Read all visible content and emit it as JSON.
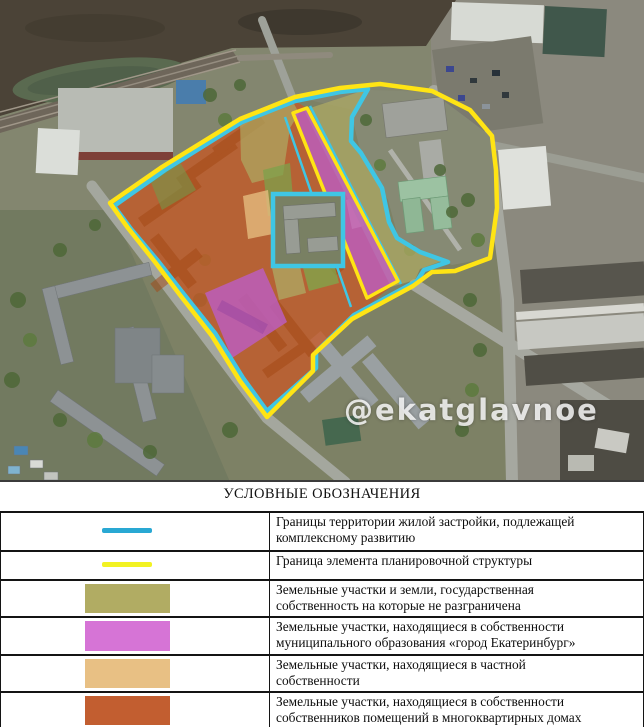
{
  "map": {
    "watermark": "@ekatglavnoe",
    "colors": {
      "boundary_cyan": "#3fc6e4",
      "boundary_yellow": "#ffe414",
      "state_unresolved": "#aeab64",
      "municipal": "#bd5ec6",
      "private": "#e5bc7e",
      "mkd": "#c65a28"
    }
  },
  "legend": {
    "title": "УСЛОВНЫЕ ОБОЗНАЧЕНИЯ",
    "rows": [
      {
        "swatch": "cyan-line",
        "color": "#29a8d3",
        "text": "Границы территории жилой застройки, подлежащей\nкомплексному развитию"
      },
      {
        "swatch": "yellow-line",
        "color": "#f2f222",
        "text": "Граница элемента планировочной структуры"
      },
      {
        "swatch": "olive-rect",
        "color": "#b1ac63",
        "text": "Земельные участки и земли, государственная\nсобственность на которые не разграничена"
      },
      {
        "swatch": "purple-rect",
        "color": "#d674d6",
        "text": "Земельные участки, находящиеся в собственности\nмуниципального образования «город Екатеринбург»"
      },
      {
        "swatch": "tan-rect",
        "color": "#e8c084",
        "text": "Земельные участки, находящиеся в частной\nсобственности"
      },
      {
        "swatch": "orange-rect",
        "color": "#c25e30",
        "text": "Земельные участки, находящиеся в собственности\nсобственников помещений в многоквартирных домах"
      }
    ]
  }
}
